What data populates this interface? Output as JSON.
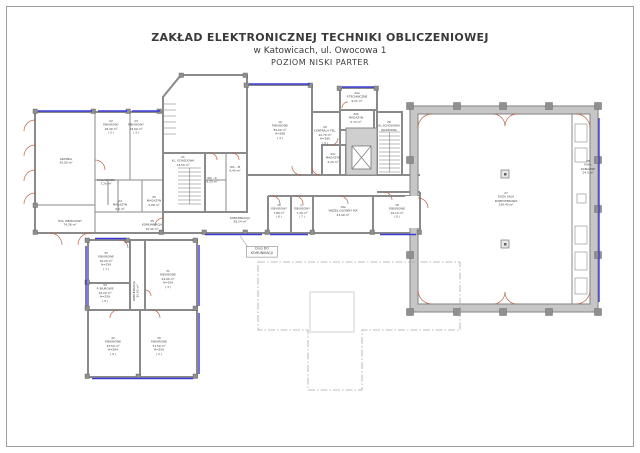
{
  "title": {
    "line1": "ZAKŁAD ELEKTRONICZNEJ TECHNIKI OBLICZENIOWEJ",
    "line2": "w Katowicach, ul. Owocowa 1",
    "line3": "POZIOM  NISKI PARTER"
  },
  "callout": {
    "line1": "CIĄG DO",
    "line2": "KOMUNIKACJI"
  },
  "colors": {
    "wall": "#8a8a8a",
    "window": "#3b3bd6",
    "door": "#b5654a",
    "text": "#3d3d3d"
  },
  "rooms": [
    {
      "name": "SZATNIA",
      "area": "50,00 m²"
    },
    {
      "num": "22",
      "name": "P.BIUROWY",
      "area": "18,40 m²",
      "idx": "( 2 )"
    },
    {
      "num": "23",
      "name": "P.BIUROWY",
      "area": "18,60 m²",
      "idx": "( 3 )"
    },
    {
      "name": "MAGAZYNEK",
      "area": "7,26 m²"
    },
    {
      "num": "24",
      "name": "MAGAZYN",
      "area": "5,6 m²"
    },
    {
      "num": "25",
      "name": "MAGAZYN",
      "area": "5,66 m²"
    },
    {
      "name": "HOL WEJŚCIOWY",
      "area": "74,36 m²"
    },
    {
      "num": "35",
      "name": "KOMUNIKACJA",
      "area": "10,40 m²"
    },
    {
      "num": "21",
      "name": "KL. SCHODOWA",
      "area": "14,50 m²"
    },
    {
      "name": "WC - K",
      "area": "6,25 m²"
    },
    {
      "name": "WC - M",
      "area": "6,40 m²"
    },
    {
      "num": "19",
      "name": "P.BIUROWE",
      "area": "50,00 m²",
      "h": "H=288",
      "idx": "( 4 )"
    },
    {
      "num": "20",
      "name": "CENTRALA TEL.",
      "area": "20,70 m²",
      "h": "H=280",
      "idx": "( 5 )"
    },
    {
      "num": "20a",
      "name": "P.TECHNICZNE",
      "area": "9,21 m²"
    },
    {
      "num": "20b",
      "name": "MAGAZYN",
      "area": "5,72 m²"
    },
    {
      "num": "20c",
      "name": "MAGAZYN",
      "area": "4,20 m²"
    },
    {
      "num": "26",
      "name": "KL.SCHODOWA",
      "name2": "ZJAZDOWA"
    },
    {
      "name": "KOMUNIKACJA",
      "area": "58,24 m²"
    },
    {
      "num": "16",
      "name": "P.BIUROWY",
      "area": "7,80 m²",
      "idx": "( 6 )"
    },
    {
      "num": "17",
      "name": "P.BIUROWY",
      "area": "7,20 m²",
      "idx": "( 7 )"
    },
    {
      "num": "19a",
      "name": "WĘZEŁ GŁÓWNY MA",
      "area": "23,40 m²"
    },
    {
      "num": "18",
      "name": "P.BIUROWE",
      "area": "16,10 m²",
      "idx": "( 8 )"
    },
    {
      "num": "27",
      "name": "DUŻA SALA",
      "name2": "KOMPUTEROWA",
      "area": "236,40 m²"
    },
    {
      "num": "28",
      "name": "POM.",
      "name2": "KABLOWE",
      "area": "24,5 m²"
    },
    {
      "num": "33",
      "name": "P.BIUROWE",
      "area": "16,20 m²",
      "h": "H=259",
      "idx": "( 1 )"
    },
    {
      "num": "34",
      "name": "P. BIUROWE",
      "area": "16,20 m²",
      "h": "H=259",
      "idx": "( 9 )"
    },
    {
      "num": "31",
      "name": "P.BIUROWE",
      "area": "24,00 m²",
      "h": "H=259",
      "idx": "( 3 )"
    },
    {
      "name": "KOMUNIKACJA",
      "area": "10,92 m²"
    },
    {
      "num": "32",
      "name": "P.BIUROWE",
      "area": "33,50 m²",
      "h": "H=264",
      "idx": "( 9 )"
    },
    {
      "num": "30",
      "name": "P.BIUROWE",
      "area": "31,50 m²",
      "h": "H=259",
      "idx": "( 2 )"
    }
  ]
}
